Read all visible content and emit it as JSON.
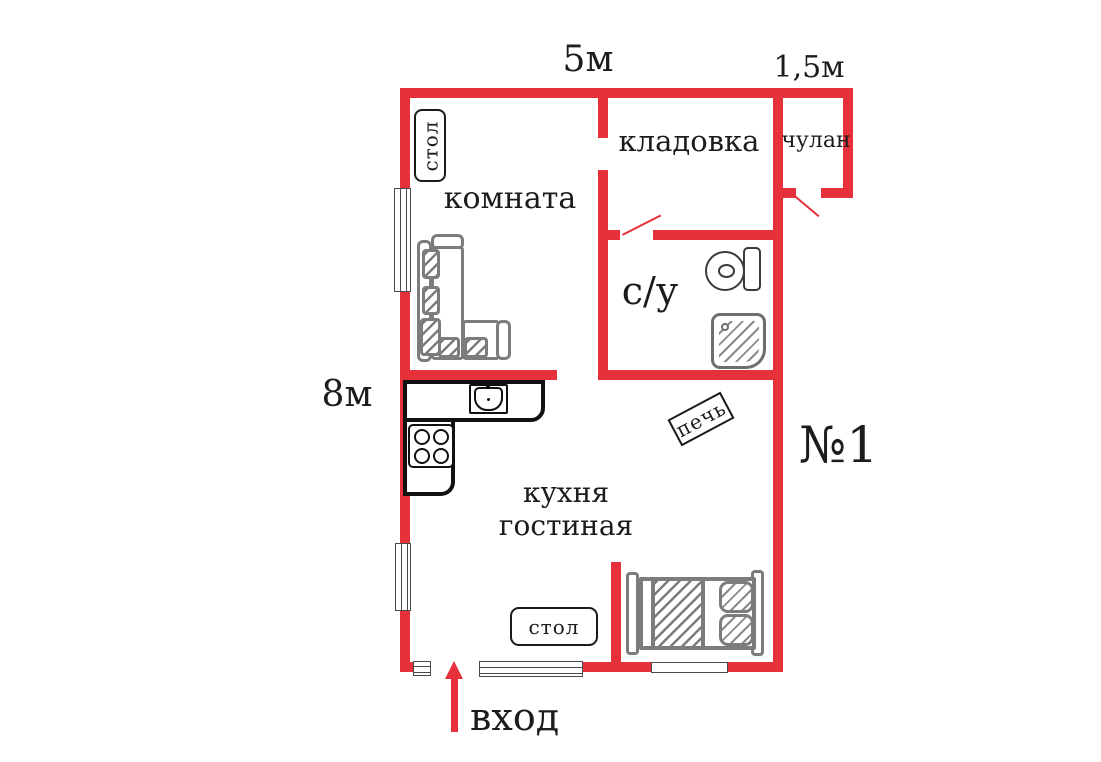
{
  "plan": {
    "unit": "№1",
    "entrance": "вход",
    "dims": {
      "top": "5м",
      "top_right": "1,5м",
      "left": "8м"
    },
    "rooms": {
      "room": "комната",
      "storage": "кладовка",
      "closet": "чулан",
      "bathroom": "с/у",
      "kitchen_line1": "кухня",
      "kitchen_line2": "гостиная"
    },
    "furniture": {
      "desk": "стол",
      "dining_table": "стол",
      "heater": "печь"
    },
    "colors": {
      "wall_red": "#e6303a",
      "furniture_gray": "#7c7c7c",
      "ink": "#1c1c1c"
    }
  }
}
